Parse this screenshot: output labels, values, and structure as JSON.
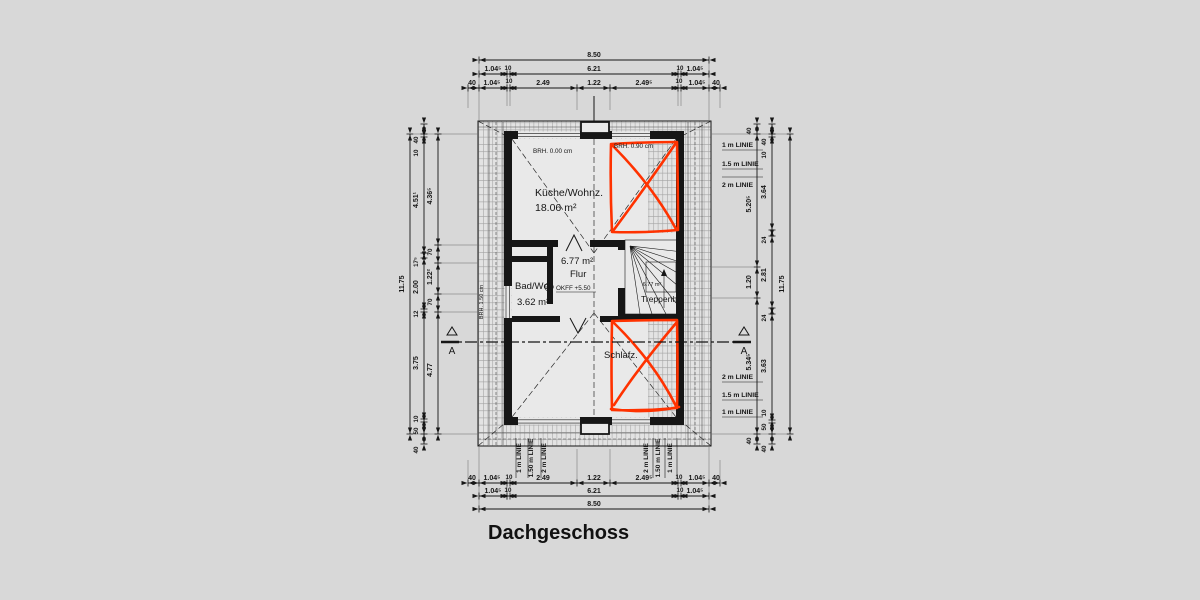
{
  "title": "Dachgeschoss",
  "colors": {
    "background": "#d8d8d8",
    "roof_hatch": "#e3e3e3",
    "interior": "#e9e9e9",
    "line": "#161616",
    "red_marker": "#ff3200"
  },
  "rooms": {
    "kitchen_living": {
      "name": "Küche/Wohnz.",
      "area": "18.06 m²"
    },
    "bath": {
      "name": "Bad/Wc",
      "area": "3.62 m²"
    },
    "hall": {
      "name": "Flur",
      "area": "6.77 m²"
    },
    "stairwell": {
      "name": "Treppenh.",
      "area": "6.77 m²"
    },
    "bedroom": {
      "name": "Schlafz."
    }
  },
  "annotations": {
    "parapet_top_left": "BRH. 0.00 cm",
    "parapet_top_right": "BRH. 0.90 cm",
    "parapet_left": "BRH. 1.50 cm",
    "floor_level": "OKFF +5.50",
    "section_label": "A"
  },
  "height_lines": {
    "right_top": [
      "1 m LINIE",
      "1.5 m LINIE",
      "2 m LINIE"
    ],
    "right_bottom": [
      "2 m LINIE",
      "1.5 m LINIE",
      "1 m LINIE"
    ],
    "bottom_left": [
      "1 m LINIE",
      "1.50 m LINIE",
      "2 m LINIE"
    ],
    "bottom_right": [
      "2 m LINIE",
      "1.50 m LINIE",
      "1 m LINIE"
    ]
  },
  "dimensions": {
    "horizontal": {
      "total": "8.50",
      "mid": [
        "1.04⁵",
        "10",
        "6.21",
        "10",
        "1.04⁵"
      ],
      "detail": [
        "40",
        "1.04⁵",
        "10",
        "2.49",
        "1.22",
        "2.49⁵",
        "10",
        "1.04⁵",
        "40"
      ]
    },
    "left": {
      "total": "11.75",
      "wall_chain": [
        "40",
        "10",
        "4.51¹",
        "17⁵",
        "2.00",
        "12",
        "3.75",
        "10",
        "50",
        "40"
      ],
      "room_chain": [
        "4.36⁵",
        "70",
        "1.22²",
        "70",
        "4.77"
      ]
    },
    "right": {
      "total": "11.75",
      "wall_chain": [
        "40",
        "10",
        "3.64",
        "24",
        "2.81",
        "24",
        "3.63",
        "10",
        "50",
        "40"
      ],
      "room_chain": [
        "40",
        "5.20⁵",
        "1.20",
        "5.34⁵",
        "40"
      ]
    }
  }
}
